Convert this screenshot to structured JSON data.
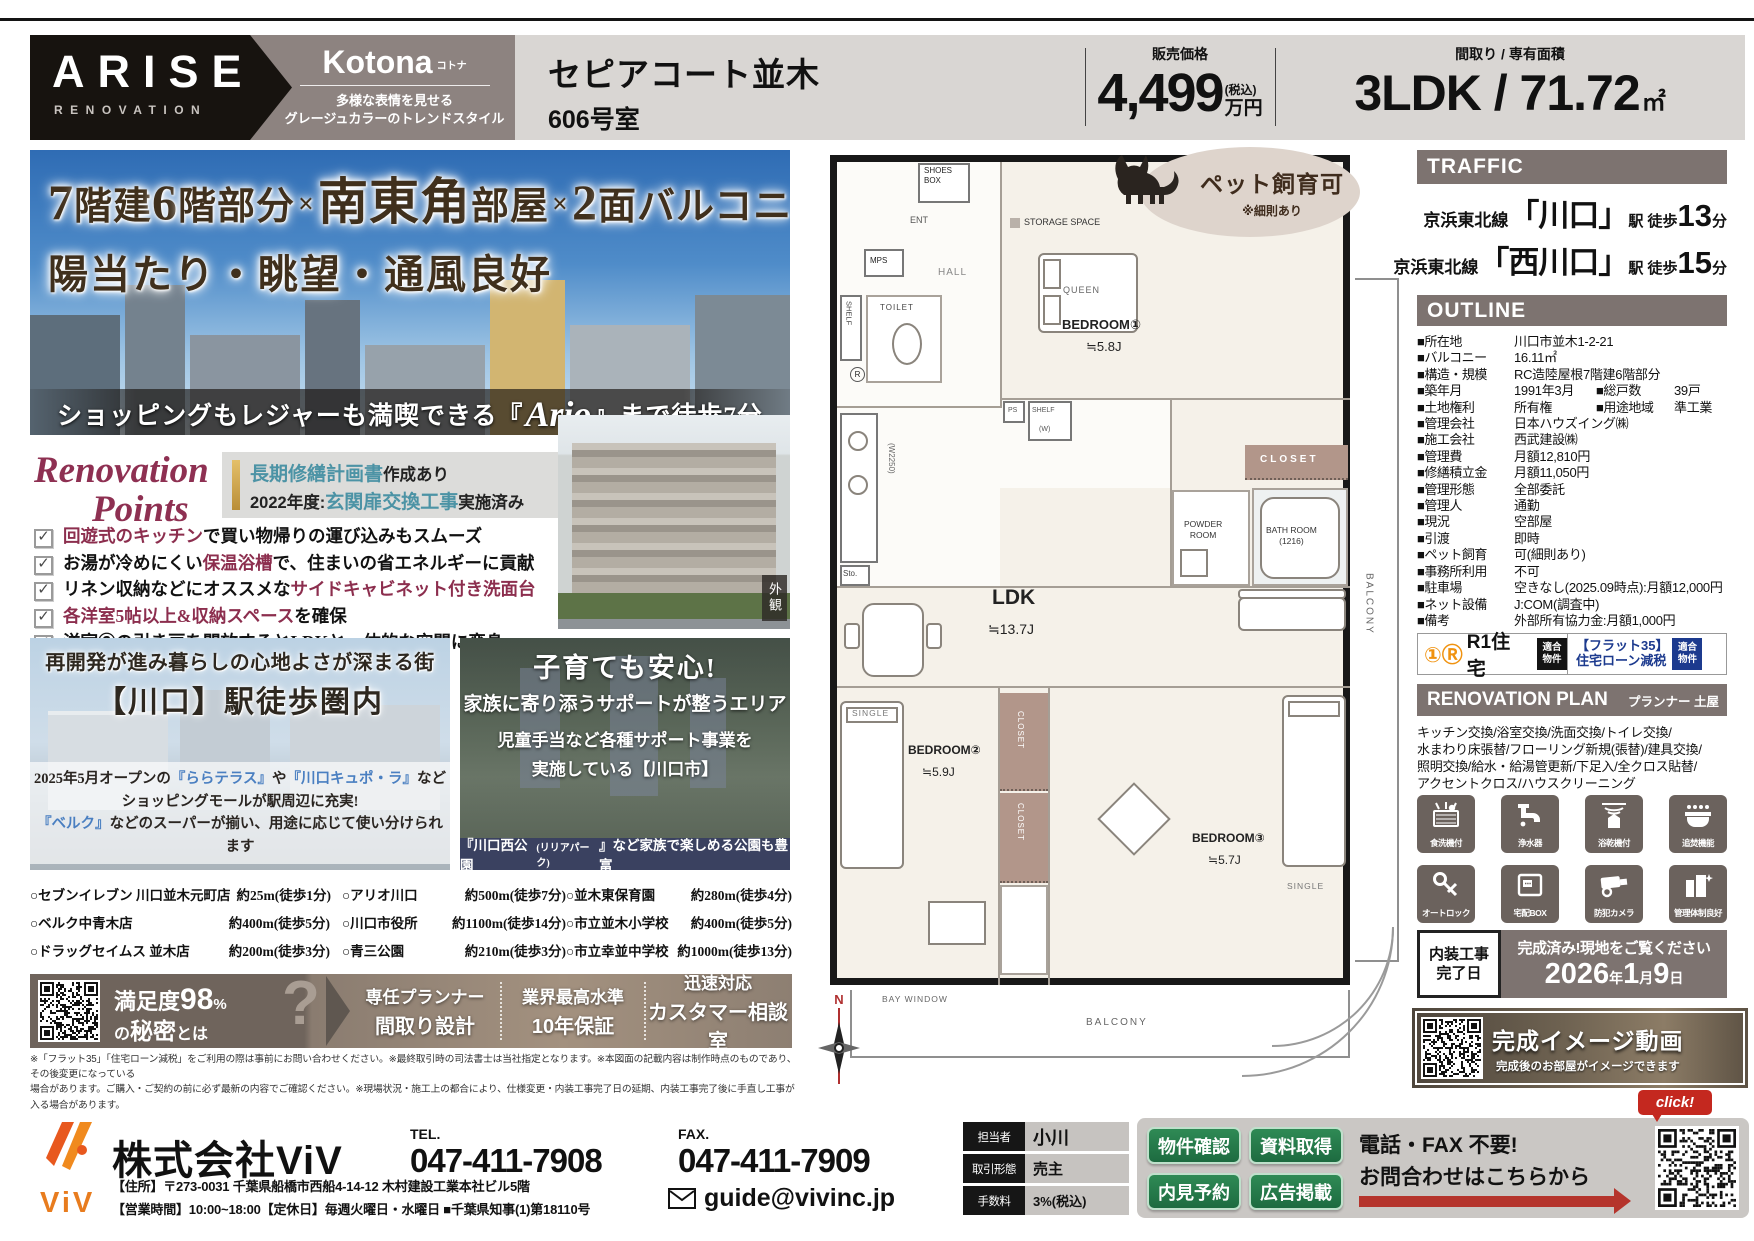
{
  "header": {
    "brand_line1": "ARISE",
    "brand_line2": "RENOVATION",
    "series_name": "Kotona",
    "series_ruby": "コトナ",
    "series_tag1": "多様な表情を見せる",
    "series_tag2": "グレージュカラーのトレンドスタイル",
    "property_name": "セピアコート並木",
    "property_unit": "606号室",
    "price_label": "販売価格",
    "price_value": "4,499",
    "price_tax": "(税込)",
    "price_unit": "万円",
    "plan_label": "間取り / 専有面積",
    "plan_value": "3LDK / 71.72",
    "plan_unit": "㎡"
  },
  "hero": {
    "headline1": [
      {
        "t": "7",
        "c": "lg"
      },
      {
        "t": "階建"
      },
      {
        "t": "6",
        "c": "lg"
      },
      {
        "t": "階部分"
      },
      {
        "t": "×",
        "c": "sm"
      },
      {
        "t": "南東角",
        "c": "lg"
      },
      {
        "t": "部屋"
      },
      {
        "t": "×",
        "c": "sm"
      },
      {
        "t": "2",
        "c": "lg"
      },
      {
        "t": "面バルコニー"
      }
    ],
    "headline2": "陽当たり・眺望・通風良好",
    "banner": [
      {
        "t": "ショッピングもレジャーも満喫できる『"
      },
      {
        "t": "Ario",
        "c": "ario"
      },
      {
        "t": "』まで徒歩7分"
      }
    ]
  },
  "renovation_points": {
    "title_line1": "Renovation",
    "title_line2": "Points",
    "note_line1": [
      {
        "t": "長期修繕計画書",
        "c": "teal"
      },
      {
        "t": "作成あり"
      }
    ],
    "note_line2": [
      {
        "t": "2022年度:"
      },
      {
        "t": "玄関扉交換工事",
        "c": "teal"
      },
      {
        "t": "実施済み"
      }
    ],
    "items": [
      [
        {
          "t": "回遊式のキッチン",
          "c": "em"
        },
        {
          "t": "で買い物帰りの運び込みもスムーズ"
        }
      ],
      [
        {
          "t": "お湯が冷めにくい"
        },
        {
          "t": "保温浴槽",
          "c": "em"
        },
        {
          "t": "で、住まいの省エネルギーに貢献"
        }
      ],
      [
        {
          "t": "リネン収納などにオススメな"
        },
        {
          "t": "サイドキャビネット付き洗面台",
          "c": "em"
        }
      ],
      [
        {
          "t": "各洋室5帖以上&収納スペース",
          "c": "em"
        },
        {
          "t": "を確保"
        }
      ],
      [
        {
          "t": "洋室③の引き戸を開放するとLDKと一体的な空間に変身"
        }
      ]
    ],
    "exterior_label": "外観"
  },
  "promo_left": {
    "title1": "再開発が進み暮らしの心地よさが深まる街",
    "title2": "【川口】駅徒歩圏内",
    "body1": [
      {
        "t": "2025年5月オープンの"
      },
      {
        "t": "『ららテラス』",
        "c": "blue"
      },
      {
        "t": "や"
      },
      {
        "t": "『川口キュポ・ラ』",
        "c": "blue"
      },
      {
        "t": "など"
      }
    ],
    "body2": [
      {
        "t": "ショッピングモールが駅周辺に充実!"
      }
    ],
    "body3": [
      {
        "t": "『ベルク』",
        "c": "blue"
      },
      {
        "t": "などのスーパーが揃い、用途に応じて使い分けられます"
      }
    ]
  },
  "promo_right": {
    "title": "子育ても安心!",
    "subtitle": "家族に寄り添うサポートが整うエリア",
    "body1": "児童手当など各種サポート事業を",
    "body2": "実施している【川口市】",
    "footer": [
      {
        "t": "『川口西公園"
      },
      {
        "t": "(リリアパーク)",
        "c": "small"
      },
      {
        "t": "』など家族で楽しめる公園も豊富"
      }
    ]
  },
  "stores": {
    "columns": [
      [
        {
          "name": "○セブンイレブン 川口並木元町店",
          "dist": "約25m(徒歩1分)"
        },
        {
          "name": "○ベルク中青木店",
          "dist": "約400m(徒歩5分)"
        },
        {
          "name": "○ドラッグセイムス 並木店",
          "dist": "約200m(徒歩3分)"
        }
      ],
      [
        {
          "name": "○アリオ川口",
          "dist": "約500m(徒歩7分)"
        },
        {
          "name": "○川口市役所",
          "dist": "約1100m(徒歩14分)"
        },
        {
          "name": "○青三公園",
          "dist": "約210m(徒歩3分)"
        }
      ],
      [
        {
          "name": "○並木東保育園",
          "dist": "約280m(徒歩4分)"
        },
        {
          "name": "○市立並木小学校",
          "dist": "約400m(徒歩5分)"
        },
        {
          "name": "○市立幸並中学校",
          "dist": "約1000m(徒歩13分)"
        }
      ]
    ]
  },
  "satisfaction": {
    "lead1_a": "満足度",
    "lead1_b": "98",
    "lead1_c": "%",
    "lead2_a": "の",
    "lead2_b": "秘密",
    "lead2_c": "とは",
    "question_mark": "?",
    "features": [
      {
        "top": "専任プランナー",
        "bottom": "間取り設計"
      },
      {
        "top": "業界最高水準",
        "bottom": "10年保証"
      },
      {
        "top": "迅速対応",
        "bottom": "カスタマー相談室"
      }
    ]
  },
  "disclaimer": {
    "line1": "※「フラット35」「住宅ローン減税」をご利用の際は事前にお問い合わせください。※最終取引時の司法書士は当社指定となります。※本図面の記載内容は制作時点のものであり、その後変更になっている",
    "line2": "場合があります。ご購入・ご契約の前に必ず最新の内容でご確認ください。※現場状況・施工上の都合により、仕様変更・内装工事完了日の延期、内装工事完了後に手直し工事が入る場合があります。"
  },
  "pet_badge": {
    "main": "ペット飼育可",
    "sub": "※細則あり"
  },
  "floorplan": {
    "compass": "N",
    "labels": [
      {
        "t": "SHOES\nBOX",
        "x": 114,
        "y": 21,
        "s": 8
      },
      {
        "t": "ENT",
        "x": 100,
        "y": 70,
        "s": 9,
        "c": "#555"
      },
      {
        "t": "STORAGE SPACE",
        "x": 214,
        "y": 72,
        "s": 9,
        "c": "#333"
      },
      {
        "t": "MPS",
        "x": 60,
        "y": 111,
        "s": 8
      },
      {
        "t": "HALL",
        "x": 128,
        "y": 122,
        "s": 10,
        "c": "#888",
        "ls": 1
      },
      {
        "t": "SHELF",
        "x": 34,
        "y": 156,
        "s": 7.5,
        "v": 1,
        "c": "#444"
      },
      {
        "t": "TOILET",
        "x": 70,
        "y": 158,
        "s": 8,
        "c": "#444",
        "ls": 1
      },
      {
        "t": "R",
        "x": 40,
        "y": 222,
        "s": 8,
        "circ": 1
      },
      {
        "t": "QUEEN",
        "x": 253,
        "y": 140,
        "s": 9,
        "c": "#666",
        "ls": 1
      },
      {
        "t": "BEDROOM①",
        "x": 252,
        "y": 172,
        "s": 13,
        "b": 1
      },
      {
        "t": "≒5.8J",
        "x": 276,
        "y": 194,
        "s": 13
      },
      {
        "t": "PS",
        "x": 198,
        "y": 262,
        "s": 7,
        "c": "#555"
      },
      {
        "t": "SHELF",
        "x": 222,
        "y": 262,
        "s": 7,
        "c": "#555"
      },
      {
        "t": "(W)",
        "x": 229,
        "y": 281,
        "s": 7,
        "c": "#555"
      },
      {
        "t": "CLOSET",
        "x": 450,
        "y": 309,
        "s": 10,
        "c": "#fff",
        "ls": 3,
        "b": 1
      },
      {
        "t": "(W2250)",
        "x": 76,
        "y": 298,
        "s": 8,
        "v": 1,
        "c": "#666"
      },
      {
        "t": "Sto.",
        "x": 33,
        "y": 424,
        "s": 8,
        "c": "#444"
      },
      {
        "t": "POWDER\nROOM",
        "x": 374,
        "y": 374,
        "s": 8.5,
        "c": "#333",
        "ctr": 1
      },
      {
        "t": "BATH ROOM\n(1216)",
        "x": 456,
        "y": 380,
        "s": 8.5,
        "c": "#333",
        "ctr": 1
      },
      {
        "t": "LDK",
        "x": 182,
        "y": 440,
        "s": 21,
        "b": 1
      },
      {
        "t": "≒13.7J",
        "x": 178,
        "y": 476,
        "s": 14
      },
      {
        "t": "BALCONY",
        "x": 552,
        "y": 428,
        "s": 10,
        "v": 1,
        "c": "#666",
        "ls": 2
      },
      {
        "t": "SINGLE",
        "x": 42,
        "y": 563,
        "s": 8.5,
        "c": "#777",
        "ls": 1
      },
      {
        "t": "BEDROOM②",
        "x": 98,
        "y": 598,
        "s": 12,
        "b": 1
      },
      {
        "t": "≒5.9J",
        "x": 112,
        "y": 620,
        "s": 12
      },
      {
        "t": "CLOSET",
        "x": 205,
        "y": 566,
        "s": 8,
        "v": 1,
        "c": "#fff",
        "ls": 1
      },
      {
        "t": "CLOSET",
        "x": 205,
        "y": 658,
        "s": 8,
        "v": 1,
        "c": "#fff",
        "ls": 1
      },
      {
        "t": "BEDROOM③",
        "x": 382,
        "y": 686,
        "s": 12,
        "b": 1
      },
      {
        "t": "≒5.7J",
        "x": 398,
        "y": 708,
        "s": 12
      },
      {
        "t": "SINGLE",
        "x": 477,
        "y": 736,
        "s": 8.5,
        "c": "#777",
        "ls": 1
      },
      {
        "t": "BAY WINDOW",
        "x": 72,
        "y": 849,
        "s": 8.5,
        "c": "#666",
        "ls": 1
      },
      {
        "t": "BALCONY",
        "x": 276,
        "y": 872,
        "s": 10,
        "c": "#666",
        "ls": 2
      }
    ]
  },
  "traffic": {
    "title": "TRAFFIC",
    "stations": [
      {
        "line": "京浜東北線",
        "station": "「川口」",
        "mid": "駅 徒歩",
        "num": "13",
        "tail": "分"
      },
      {
        "line": "京浜東北線",
        "station": "「西川口」",
        "mid": "駅 徒歩",
        "num": "15",
        "tail": "分"
      }
    ]
  },
  "outline": {
    "title": "OUTLINE",
    "rows": [
      {
        "l": "■所在地",
        "v": "川口市並木1-2-21"
      },
      {
        "l": "■バルコニー",
        "v": "16.11㎡"
      },
      {
        "l": "■構造・規模",
        "v": "RC造陸屋根7階建6階部分"
      },
      {
        "l": "■築年月",
        "v": "1991年3月",
        "l2": "■総戸数",
        "v2": "39戸"
      },
      {
        "l": "■土地権利",
        "v": "所有権",
        "l2": "■用途地域",
        "v2": "準工業"
      },
      {
        "l": "■管理会社",
        "v": "日本ハウズイング㈱"
      },
      {
        "l": "■施工会社",
        "v": "西武建設㈱"
      },
      {
        "l": "■管理費",
        "v": "月額12,810円"
      },
      {
        "l": "■修繕積立金",
        "v": "月額11,050円"
      },
      {
        "l": "■管理形態",
        "v": "全部委託"
      },
      {
        "l": "■管理人",
        "v": "通勤"
      },
      {
        "l": "■現況",
        "v": "空部屋"
      },
      {
        "l": "■引渡",
        "v": "即時"
      },
      {
        "l": "■ペット飼育",
        "v": "可(細則あり)"
      },
      {
        "l": "■事務所利用",
        "v": "不可"
      },
      {
        "l": "■駐車場",
        "v": "空きなし(2025.09時点):月額12,000円"
      },
      {
        "l": "■ネット設備",
        "v": "J:COM(調査中)"
      },
      {
        "l": "■備考",
        "v": "外部所有協力金:月額1,000円"
      }
    ]
  },
  "badges": {
    "r1_icon": "①Ⓡ",
    "r1_name": "R1住宅",
    "r1_tag1": "適合",
    "r1_tag2": "物件",
    "flat_line1": "【フラット35】",
    "flat_line2": "住宅ローン減税",
    "flat_tag1": "適合",
    "flat_tag2": "物件"
  },
  "renovation_plan": {
    "title": "RENOVATION PLAN",
    "planner": "プランナー 土屋",
    "lines": [
      "キッチン交換/浴室交換/洗面交換/トイレ交換/",
      "水まわり床張替/フローリング新規(張替)/建具交換/",
      "照明交換/給水・給湯管更新/下足入/全クロス貼替/",
      "アクセントクロス/ハウスクリーニング"
    ],
    "features": [
      {
        "icon": "dishwasher",
        "label": "食洗機付"
      },
      {
        "icon": "purifier",
        "label": "浄水器"
      },
      {
        "icon": "bathdryer",
        "label": "浴乾機付"
      },
      {
        "icon": "reheat",
        "label": "追焚機能"
      },
      {
        "icon": "autolock",
        "label": "オートロック"
      },
      {
        "icon": "deliverybox",
        "label": "宅配BOX"
      },
      {
        "icon": "camera",
        "label": "防犯カメラ"
      },
      {
        "icon": "management",
        "label": "管理体制良好"
      }
    ]
  },
  "completion": {
    "box_line1": "内装工事",
    "box_line2": "完了日",
    "message": "完成済み!現地をご覧ください",
    "date": [
      {
        "t": "2026",
        "c": "num"
      },
      {
        "t": "年",
        "c": "u"
      },
      {
        "t": "1",
        "c": "num"
      },
      {
        "t": "月",
        "c": "u"
      },
      {
        "t": "9",
        "c": "num"
      },
      {
        "t": "日",
        "c": "u"
      }
    ]
  },
  "video_banner": {
    "title": "完成イメージ動画",
    "subtitle": "完成後のお部屋がイメージできます"
  },
  "footer": {
    "logo_text": "ViV",
    "company": "株式会社ViV",
    "tel_label": "TEL.",
    "tel": "047-411-7908",
    "fax_label": "FAX.",
    "fax": "047-411-7909",
    "address": "【住所】〒273-0031 千葉県船橋市西船4-14-12 木村建設工業本社ビル5階",
    "hours": "【営業時間】10:00~18:00【定休日】毎週火曜日・水曜日 ■千葉県知事(1)第18110号",
    "email": "guide@vivinc.jp",
    "table": [
      {
        "label": "担当者",
        "value": "小川",
        "cls": "v0"
      },
      {
        "label": "取引形態",
        "value": "売主",
        "cls": "v1"
      },
      {
        "label": "手数料",
        "value": "3%(税込)",
        "cls": "v2"
      }
    ],
    "buttons": [
      "物件確認",
      "資料取得",
      "内見予約",
      "広告掲載"
    ],
    "cta_line1": "電話・FAX 不要!",
    "cta_line2": "お問合わせはこちらから",
    "click": "click!"
  },
  "colors": {
    "accent_red": "#8c2e4e",
    "teal": "#4c93a5",
    "taupe": "#7d7370",
    "navy": "#1c3a8e",
    "green": "#1d6b40",
    "red": "#c4281f"
  }
}
